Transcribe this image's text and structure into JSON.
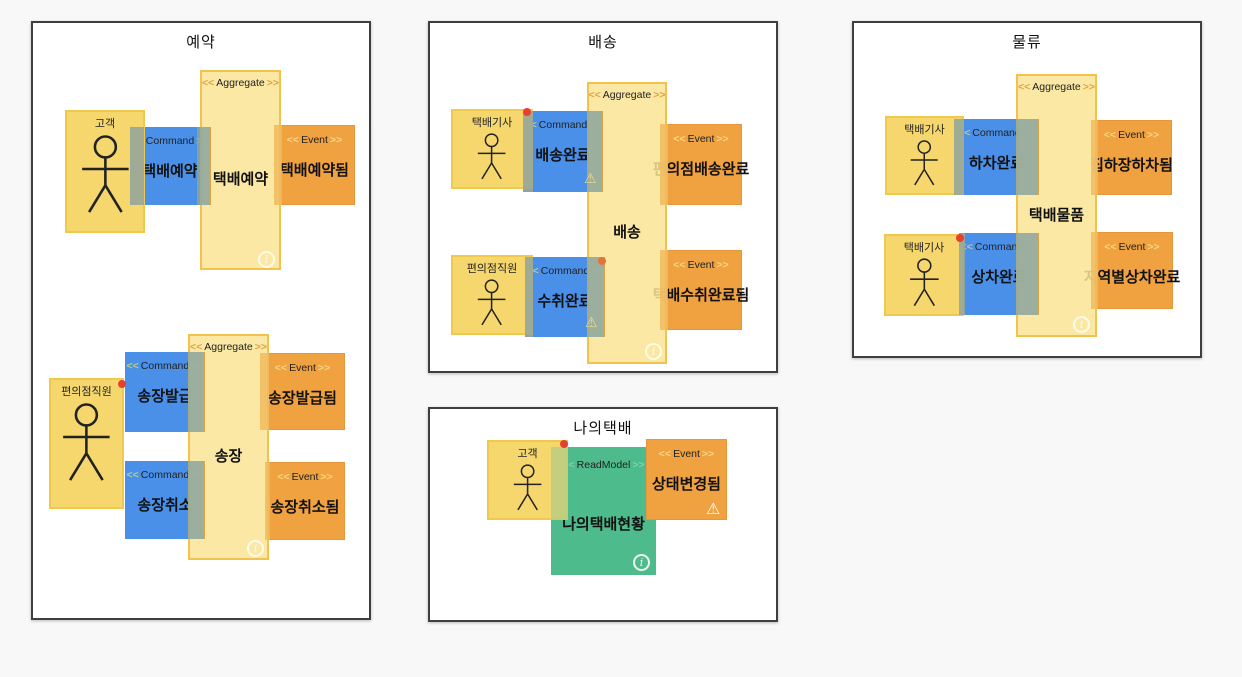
{
  "ui": {
    "chevron_open": "<<",
    "chevron_close": ">>",
    "types": {
      "command": "Command",
      "aggregate": "Aggregate",
      "event": "Event",
      "readmodel": "ReadModel"
    }
  },
  "palette": {
    "canvas_bg": "#F8F8F8",
    "context_bg": "#FFFFFF",
    "context_border": "#3F3F3F",
    "actor": "#F5D76D",
    "command": "#4A90E8",
    "aggregate": "#FAE494",
    "event": "#F0A140",
    "readmodel": "#4DBB8B",
    "overlap_gray_green": "#9BAF9F",
    "overlap_orange": "#F3C168",
    "alert_dot_red": "#E6402E",
    "alert_dot_orange": "#E2743C"
  },
  "icons": {
    "info": "i",
    "warning": "⚠"
  },
  "contexts": [
    {
      "title": "예약",
      "stickers": [
        {
          "type": "actor",
          "label": "고객"
        },
        {
          "type": "command",
          "label": "택배예약"
        },
        {
          "type": "aggregate",
          "label": "택배예약"
        },
        {
          "type": "event",
          "label": "택배예약됨"
        },
        {
          "type": "actor",
          "label": "편의점직원"
        },
        {
          "type": "command",
          "label": "송장발급"
        },
        {
          "type": "command",
          "label": "송장취소"
        },
        {
          "type": "aggregate",
          "label": "송장"
        },
        {
          "type": "event",
          "label": "송장발급됨"
        },
        {
          "type": "event",
          "label": "송장취소됨"
        }
      ]
    },
    {
      "title": "배송",
      "stickers": [
        {
          "type": "actor",
          "label": "택배기사"
        },
        {
          "type": "command",
          "label": "배송완료"
        },
        {
          "type": "aggregate",
          "label": "배송"
        },
        {
          "type": "event",
          "label": "편의점배송완료"
        },
        {
          "type": "actor",
          "label": "편의점직원"
        },
        {
          "type": "command",
          "label": "수취완료"
        },
        {
          "type": "event",
          "label": "택배수취완료됨"
        }
      ]
    },
    {
      "title": "물류",
      "stickers": [
        {
          "type": "actor",
          "label": "택배기사"
        },
        {
          "type": "command",
          "label": "하차완료"
        },
        {
          "type": "aggregate",
          "label": "택배물품"
        },
        {
          "type": "event",
          "label": "집하장하차됨"
        },
        {
          "type": "actor",
          "label": "택배기사"
        },
        {
          "type": "command",
          "label": "상차완료"
        },
        {
          "type": "event",
          "label": "지역별상차완료"
        }
      ]
    },
    {
      "title": "나의택배",
      "stickers": [
        {
          "type": "actor",
          "label": "고객"
        },
        {
          "type": "readmodel",
          "label": "나의택배현황"
        },
        {
          "type": "event",
          "label": "상태변경됨"
        }
      ]
    }
  ]
}
